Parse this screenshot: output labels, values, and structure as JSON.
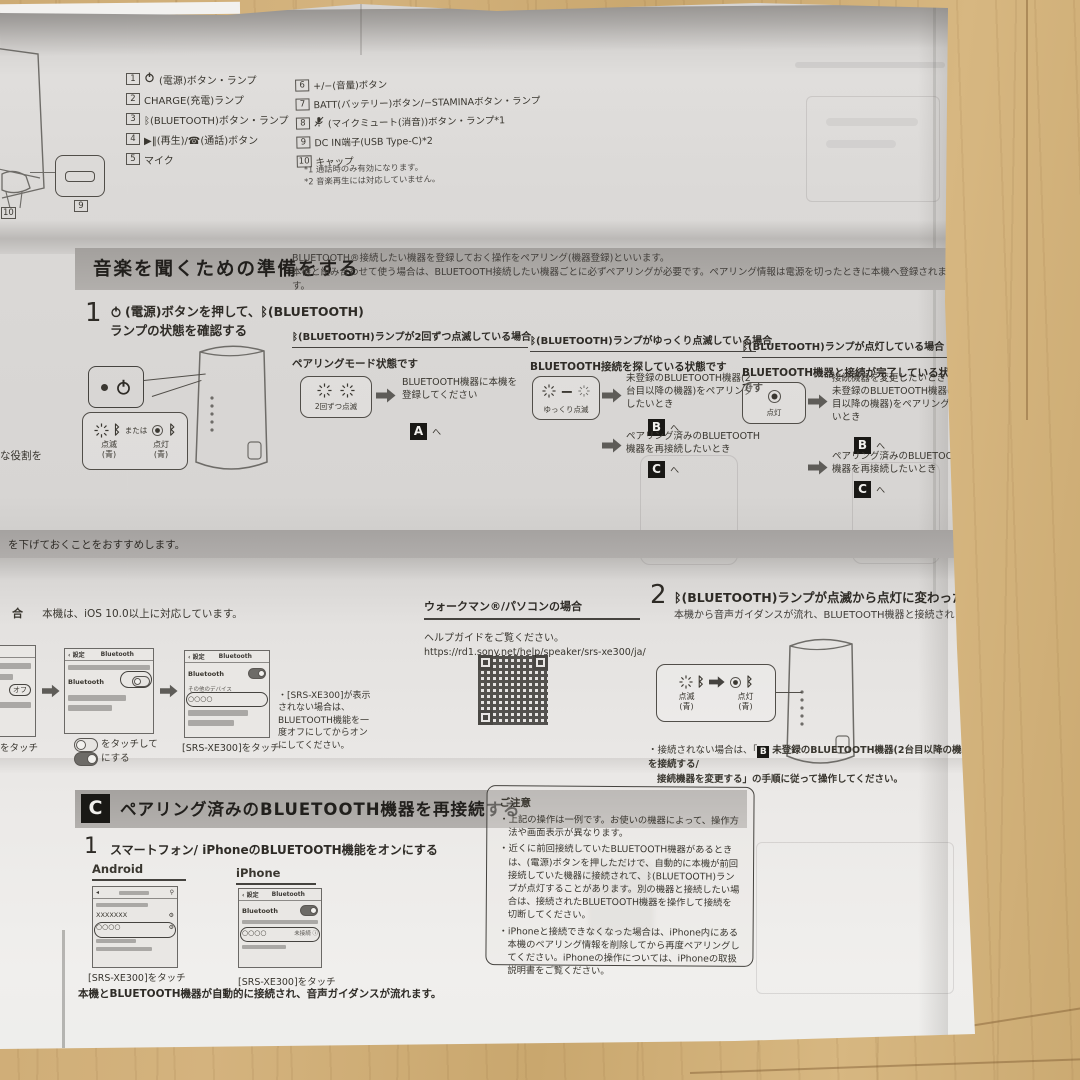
{
  "icons": {
    "bt": "ᛒ"
  },
  "parts": {
    "items_left": [
      {
        "n": "1",
        "label": "(電源)ボタン・ランプ"
      },
      {
        "n": "2",
        "label": "CHARGE(充電)ランプ"
      },
      {
        "n": "3",
        "label": "ᛒ(BLUETOOTH)ボタン・ランプ"
      },
      {
        "n": "4",
        "label": "▶‖(再生)/☎(通話)ボタン"
      },
      {
        "n": "5",
        "label": "マイク"
      }
    ],
    "items_right": [
      {
        "n": "6",
        "label": "+/−(音量)ボタン"
      },
      {
        "n": "7",
        "label": "BATT(バッテリー)ボタン/−STAMINAボタン・ランプ"
      },
      {
        "n": "8",
        "label": "(マイクミュート(消音))ボタン・ランプ*1"
      },
      {
        "n": "9",
        "label": "DC IN端子(USB Type-C)*2"
      },
      {
        "n": "10",
        "label": "キャップ"
      }
    ],
    "foot1": "*1 通話時のみ有効になります。",
    "foot2": "*2 音楽再生には対応していません。",
    "c9": "9",
    "c10": "10"
  },
  "prep": {
    "title": "音楽を聞くための準備をする",
    "intro1": "BLUETOOTH®接続したい機器を登録しておく操作をペアリング(機器登録)といいます。",
    "intro2": "本機と組み合わせて使う場合は、BLUETOOTH接続したい機器ごとに必ずペアリングが必要です。ペアリング情報は電源を切ったときに本機へ登録されます。"
  },
  "step1": {
    "num": "1",
    "t1": "(電源)ボタンを押して、ᛒ(BLUETOOTH)",
    "t2": "ランプの状態を確認する",
    "or": "または",
    "blink": "点滅",
    "blue1": "(青)",
    "lit": "点灯",
    "blue2": "(青)"
  },
  "caseA": {
    "header": "ᛒ(BLUETOOTH)ランプが2回ずつ点滅している場合",
    "state": "ペアリングモード状態です",
    "box": "2回ずつ点滅",
    "action": "BLUETOOTH機器に本機を登録してください",
    "badge": "A",
    "go": "へ"
  },
  "caseB": {
    "header": "ᛒ(BLUETOOTH)ランプがゆっくり点滅している場合",
    "state": "BLUETOOTH接続を探している状態です",
    "box": "ゆっくり点滅",
    "action1": "未登録のBLUETOOTH機器(2台目以降の機器)をペアリングしたいとき",
    "badge1": "B",
    "action2": "ペアリング済みのBLUETOOTH機器を再接続したいとき",
    "badge2": "C",
    "go": "へ"
  },
  "caseC": {
    "header": "ᛒ(BLUETOOTH)ランプが点灯している場合",
    "state": "BLUETOOTH機器と接続が完了している状態です",
    "box": "点灯",
    "action1a": "接続機器を変更したいとき",
    "action1b": "未登録のBLUETOOTH機器(2台目以降の機器)をペアリングしたいとき",
    "badge1": "B",
    "action2": "ペアリング済みのBLUETOOTH機器を再接続したいとき",
    "badge2": "C",
    "go": "へ"
  },
  "left_edge": {
    "role": "な役割を",
    "band": "を下げておくことをおすすめします。",
    "ios_head": "合",
    "ios_note": "本機は、iOS 10.0以上に対応しています。",
    "off": "オフ",
    "cap1": "をタッチ"
  },
  "phones": {
    "set_back": "設定",
    "bt_title": "Bluetooth",
    "bt_row": "Bluetooth",
    "shot2_cap1": "をタッチして",
    "shot2_cap2": "にする",
    "other": "その他のデバイス",
    "device": "○○○○",
    "shot3_cap": "[SRS-XE300]をタッチ",
    "note": "・[SRS-XE300]が表示されない場合は、BLUETOOTH機能を一度オフにしてからオンにしてください。"
  },
  "walkman": {
    "header": "ウォークマン®/パソコンの場合",
    "help": "ヘルプガイドをご覧ください。",
    "url": "https://rd1.sony.net/help/speaker/srs-xe300/ja/"
  },
  "step2": {
    "num": "2",
    "title": "ᛒ(BLUETOOTH)ランプが点滅から点灯に変わったことを確認する",
    "sub": "本機から音声ガイダンスが流れ、BLUETOOTH機器と接続されます。",
    "blink": "点滅",
    "blue1": "(青)",
    "lit": "点灯",
    "blue2": "(青)",
    "note_pre": "・接続されない場合は、「",
    "note_b": "B",
    "note_mid": "未登録のBLUETOOTH機器(2台目以降の機器)を接続する/",
    "note_l2": "接続機器を変更する」の手順に従って操作してください。"
  },
  "secC": {
    "badge": "C",
    "title": "ペアリング済みのBLUETOOTH機器を再接続する",
    "num": "1",
    "step": "スマートフォン/ iPhoneのBLUETOOTH機能をオンにする",
    "android": "Android",
    "iphone": "iPhone",
    "and_x": "XXXXXXX",
    "and_dev": "○○○○",
    "iph_dev": "○○○○",
    "iph_status": "未接続",
    "info": "i",
    "cap_a": "[SRS-XE300]をタッチ",
    "cap_i": "[SRS-XE300]をタッチ",
    "result": "本機とBLUETOOTH機器が自動的に接続され、音声ガイダンスが流れます。"
  },
  "notice": {
    "title": "ご注意",
    "b1": "・上記の操作は一例です。お使いの機器によって、操作方法や画面表示が異なります。",
    "b2": "・近くに前回接続していたBLUETOOTH機器があるときは、(電源)ボタンを押しただけで、自動的に本機が前回接続していた機器に接続されて、ᛒ(BLUETOOTH)ランプが点灯することがあります。別の機器と接続したい場合は、接続されたBLUETOOTH機器を操作して接続を切断してください。",
    "b3": "・iPhoneと接続できなくなった場合は、iPhone内にある本機のペアリング情報を削除してから再度ペアリングしてください。iPhoneの操作については、iPhoneの取扱説明書をご覧ください。"
  }
}
